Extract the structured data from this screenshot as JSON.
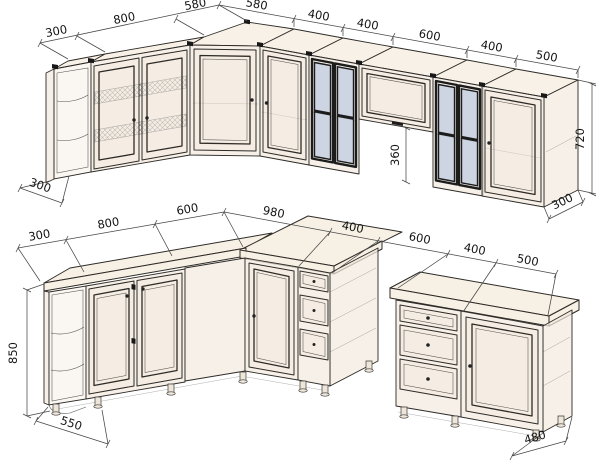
{
  "colors": {
    "background": "#ffffff",
    "cabinet_fill": "#f3eadf",
    "cabinet_fill_light": "#f7f0e4",
    "glass": "#c6d0e2",
    "outline": "#2e2b27",
    "dimension_line": "#474747",
    "dimension_text": "#141414",
    "hardware_black": "#181818"
  },
  "dims": {
    "upper": {
      "run": [
        "300",
        "800",
        "580",
        "580",
        "400",
        "400",
        "600",
        "400",
        "500"
      ],
      "height": "720",
      "hood_height": "360",
      "left_depth": "300",
      "right_depth": "300"
    },
    "base": {
      "run": [
        "300",
        "800",
        "600",
        "980",
        "400",
        "600",
        "400",
        "500"
      ],
      "height": "850",
      "left_depth": "550",
      "island_depth": "480"
    }
  }
}
